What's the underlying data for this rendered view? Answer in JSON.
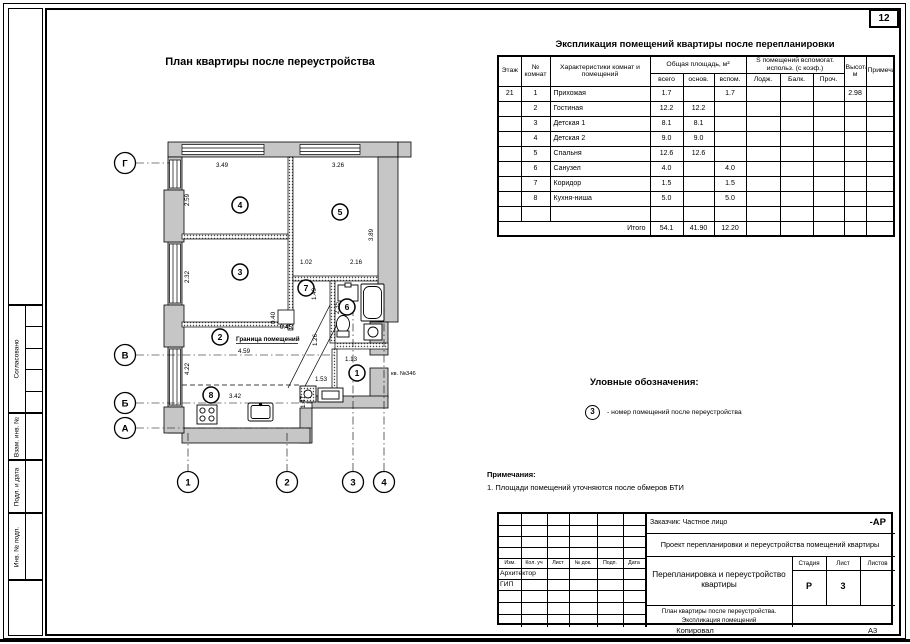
{
  "page": {
    "corner_number": "12",
    "copied_label": "Копировал",
    "format_label": "А3"
  },
  "left_margin": {
    "agreed": "Согласовано",
    "replace_inv": "Взам. инв. №",
    "sign_date": "Подл. и дата",
    "inv_orig": "Инв. № подп."
  },
  "plan": {
    "title": "План квартиры после переустройства",
    "boundary_label": "Граница помещений",
    "apartment_label": "кв. №346",
    "room_numbers": [
      "1",
      "2",
      "3",
      "4",
      "5",
      "6",
      "7",
      "8"
    ],
    "axes_rows": [
      "Г",
      "В",
      "Б",
      "А"
    ],
    "axes_cols": [
      "1",
      "2",
      "3",
      "4"
    ],
    "dims": {
      "top_left": "3.49",
      "top_right": "3.26",
      "left_upper": "2.59",
      "left_mid": "2.32",
      "left_lower": "4.22",
      "right": "3.89",
      "hall_w": "1.02",
      "bath_w": "2.16",
      "hall_h": "1.49",
      "bath_h": "2.35",
      "niche_d": "0.40",
      "niche_w": "0.45",
      "corr_h": "1.26",
      "living_w": "4.59",
      "entry_w": "1.13",
      "cab_w": "1.53",
      "kitchen_w": "3.42",
      "kitchen_h": "1.47"
    }
  },
  "explication": {
    "title": "Экспликация помещений квартиры после перепланировки",
    "headers": {
      "floor": "Этаж",
      "room_no": "№ комнат",
      "desc": "Характеристики комнат и помещений",
      "total_area_group": "Общая площадь, м²",
      "total": "всего",
      "main": "основ.",
      "aux": "вспом.",
      "aux_group": "S помещений вспомогат. использ. (с коэф.)",
      "loggia": "Лодж.",
      "balcony": "Балк.",
      "other": "Проч.",
      "height": "Высота, м",
      "note": "Примечание"
    },
    "rows": [
      [
        "21",
        "1",
        "Прихожая",
        "1.7",
        "",
        "1.7",
        "",
        "",
        "",
        "2.98",
        ""
      ],
      [
        "",
        "2",
        "Гостиная",
        "12.2",
        "12.2",
        "",
        "",
        "",
        "",
        "",
        ""
      ],
      [
        "",
        "3",
        "Детская 1",
        "8.1",
        "8.1",
        "",
        "",
        "",
        "",
        "",
        ""
      ],
      [
        "",
        "4",
        "Детская 2",
        "9.0",
        "9.0",
        "",
        "",
        "",
        "",
        "",
        ""
      ],
      [
        "",
        "5",
        "Спальня",
        "12.6",
        "12.6",
        "",
        "",
        "",
        "",
        "",
        ""
      ],
      [
        "",
        "6",
        "Санузел",
        "4.0",
        "",
        "4.0",
        "",
        "",
        "",
        "",
        ""
      ],
      [
        "",
        "7",
        "Коридор",
        "1.5",
        "",
        "1.5",
        "",
        "",
        "",
        "",
        ""
      ],
      [
        "",
        "8",
        "Кухня-ниша",
        "5.0",
        "",
        "5.0",
        "",
        "",
        "",
        "",
        ""
      ],
      [
        "",
        "",
        "",
        "",
        "",
        "",
        "",
        "",
        "",
        "",
        ""
      ]
    ],
    "total_label": "Итого",
    "totals": [
      "54.1",
      "41.90",
      "12.20"
    ]
  },
  "legend": {
    "title": "Уловные обозначения:",
    "symbol": "3",
    "text": "- номер помещений после переустройства"
  },
  "notes": {
    "title": "Примечания:",
    "line1": "1. Площади помещений уточняются после обмеров БТИ"
  },
  "title_block": {
    "customer": "Заказчик: Частное лицо",
    "code": "-АР",
    "project": "Проект перепланировки и переустройства помещений квартиры",
    "cols": [
      "Изм.",
      "Кол. уч",
      "Лист",
      "№ док.",
      "Подп.",
      "Дата"
    ],
    "role_architect": "Архитектор",
    "role_gip": "ГИП",
    "doc_title": "Перепланировка и переустройство квартиры",
    "sheet_title_1": "План квартиры после переустройства.",
    "sheet_title_2": "Экспликация помещений",
    "stage_label": "Стадия",
    "sheet_label": "Лист",
    "sheets_label": "Листов",
    "stage": "Р",
    "sheet": "3",
    "sheets": ""
  }
}
